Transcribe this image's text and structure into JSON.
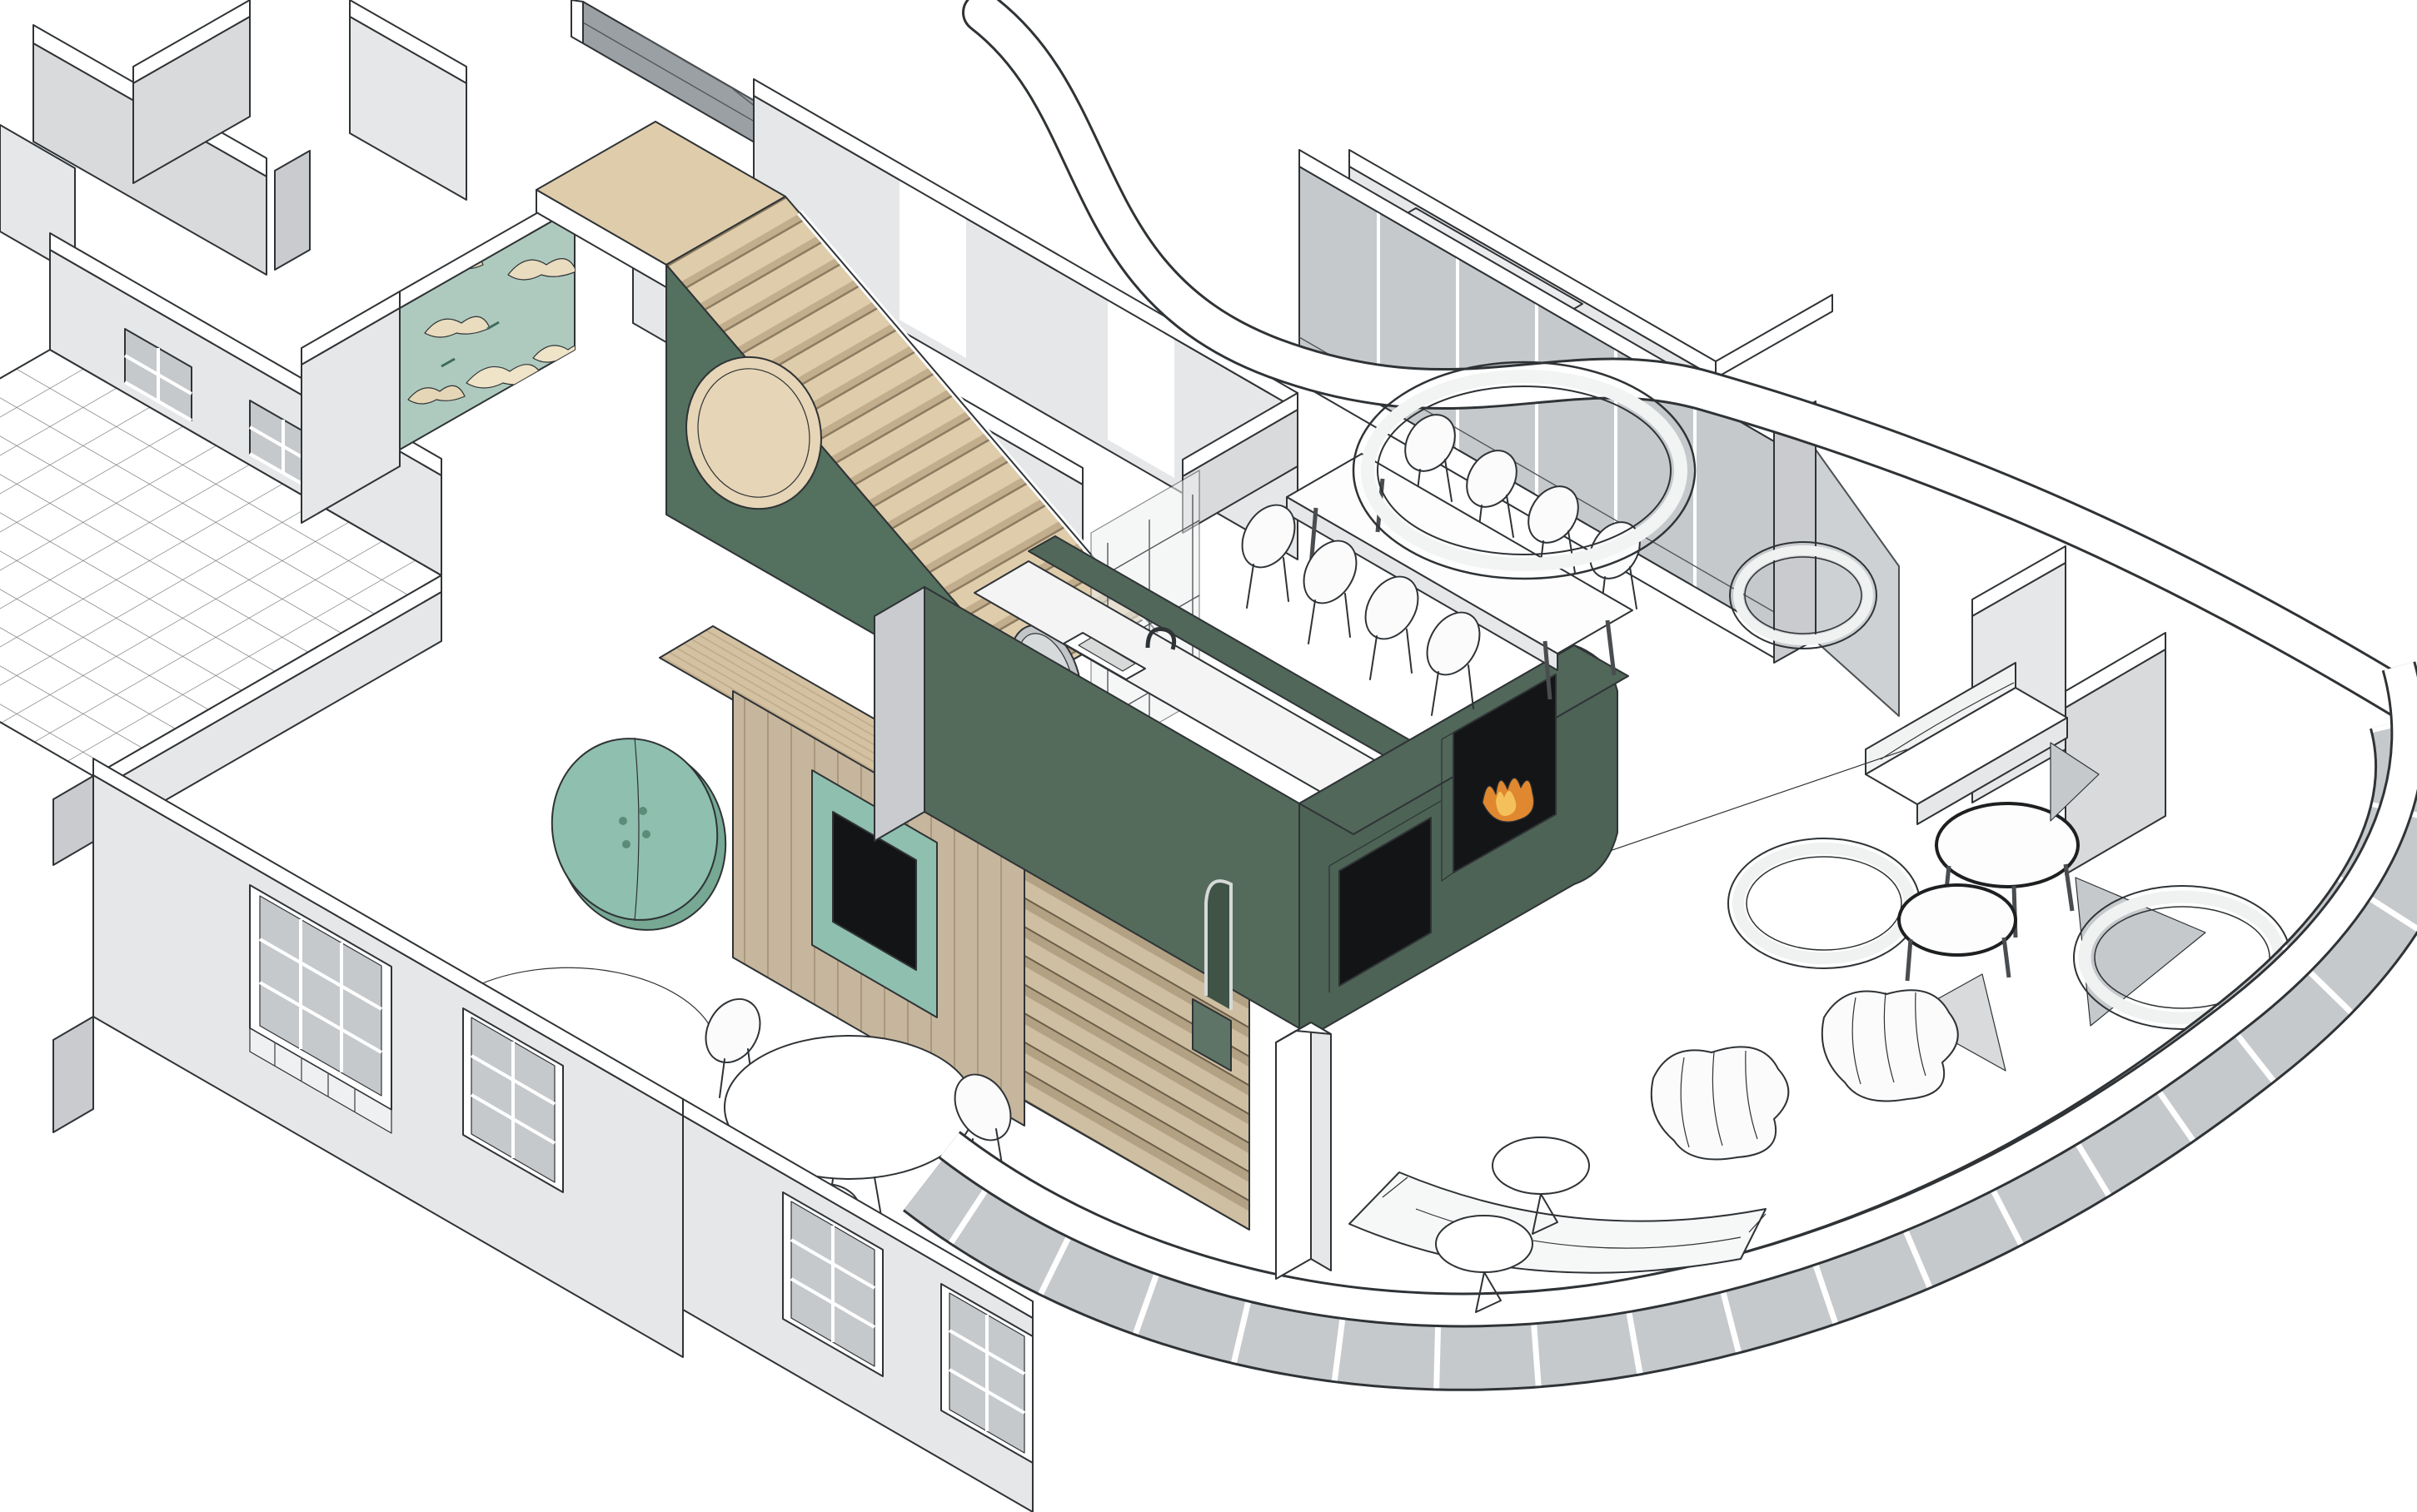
{
  "document": {
    "type": "axonometric-cutaway-interior-rendering",
    "description": "3D isometric cutaway floor plan of an apartment with curved glazed facade, central dark-green kitchen fireplace monolith, feature staircase with green stringer wall and crane wallpaper, tiled terrace, dining and living areas",
    "background": "#ffffff"
  },
  "palette": {
    "line": "#2f3336",
    "wall_white": "#ffffff",
    "wall_light": "#e6e7e9",
    "wall_mid": "#d9dadc",
    "wall_dark": "#c9cbce",
    "glass": "#c6c9cc",
    "glass_dark": "#9aa0a4",
    "kitchen_green_front": "#4c6355",
    "kitchen_green_side": "#546b5c",
    "kitchen_green_top": "#50675a",
    "stair_green": "#54705f",
    "step_green": "#87a694",
    "step_green_dark": "#6f8f7e",
    "wood_top": "#dfccab",
    "wood_face": "#d3c1a2",
    "wood_dark": "#b9a585",
    "panel_wood": "#c6b69d",
    "slat_wood": "#cfbfa2",
    "mint": "#8fbfae",
    "mint_light": "#a9cfc0",
    "mint_dark": "#76a894",
    "wallpaper_teal": "#aecabe",
    "wallpaper_cream": "#e9dcbf",
    "niche_beige": "#e6d5b6",
    "counter_white": "#f3f4f3",
    "tv_black": "#131416",
    "fire_orange": "#e0882f",
    "fire_yellow": "#f4c05a",
    "fabric_white": "#fbfbfc"
  },
  "inventory": {
    "terrace": {
      "floor": "white diagonal tile grid",
      "parapet": true,
      "windows_on_wall": 2
    },
    "stair_hall": {
      "treads_flight": 16,
      "lower_green_steps": 3,
      "round_niche": 1,
      "crane_wallpaper_wall": 1,
      "oval_mirror": 1
    },
    "media_room": {
      "tv_screens": 1,
      "teal_drum_table": 1,
      "wood_panel_wall": 1,
      "louver_wall_slats": 9,
      "rug_arc": 1
    },
    "kitchen": {
      "monolith_color": "dark green",
      "sink": 1,
      "faucet": 1,
      "fireplace": 1,
      "tv_recess": 1,
      "arch_niche": 1,
      "white_column": 1
    },
    "dining": {
      "table": 1,
      "chairs": 8,
      "ring_light": 1,
      "curtain_wall_panels": 6
    },
    "living": {
      "lounge_chairs": 2,
      "side_tables": 2,
      "sofa": 1,
      "coffee_table": 1,
      "bay_glazing_panels": 6
    },
    "right_wing": {
      "daybed": 1,
      "wire_table": 1,
      "ring_lights": 3,
      "cut_wall_triangles": 3
    },
    "breakfast_nook": {
      "round_table": 1,
      "chairs": 3,
      "facade_windows": 4
    },
    "roof_band": "white S-curved cut slab edge wrapping the curved facade"
  }
}
